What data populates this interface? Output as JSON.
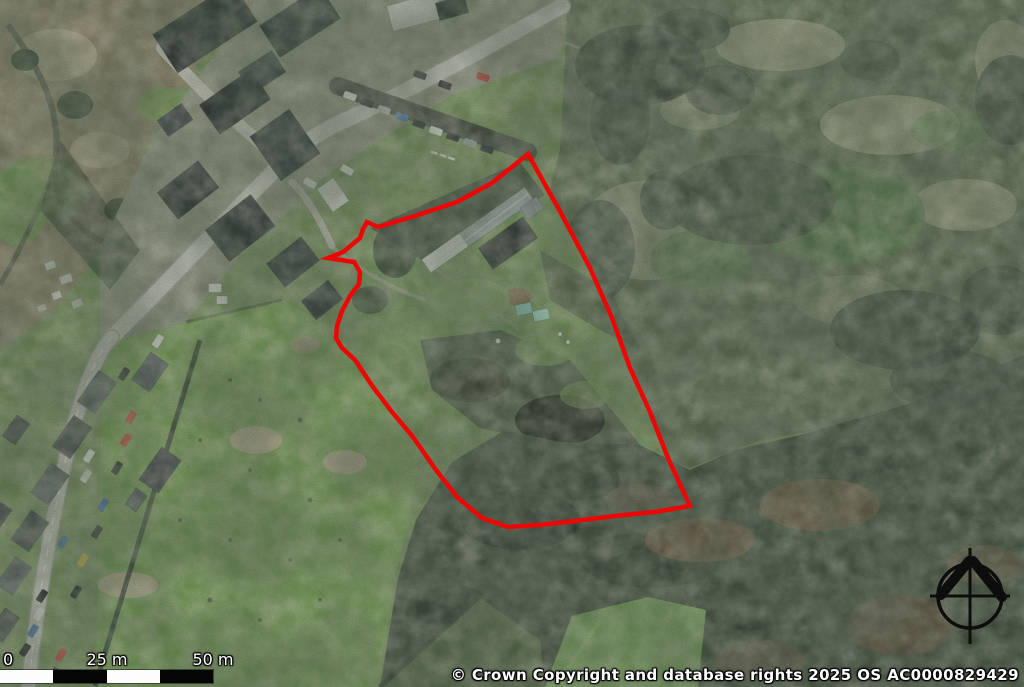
{
  "map": {
    "type": "aerial-photo-with-site-outline",
    "boundary_color": "#ec0606",
    "boundary_points": "528,154 562,215 590,268 612,318 630,368 650,412 668,458 690,506 655,512 615,516 575,521 540,525 508,527 482,518 458,498 436,470 413,437 392,412 373,387 355,360 342,348 336,338 337,326 342,311 350,296 359,284 360,272 354,262 328,258 343,252 360,238 363,229 367,222 378,227 415,216 457,202 492,183 512,167"
  },
  "scale_bar": {
    "labels": [
      "0",
      "25 m",
      "50 m"
    ]
  },
  "attribution": {
    "text": "© Crown Copyright and database rights 2025 OS AC0000829429"
  },
  "compass": {
    "name": "north-arrow"
  }
}
